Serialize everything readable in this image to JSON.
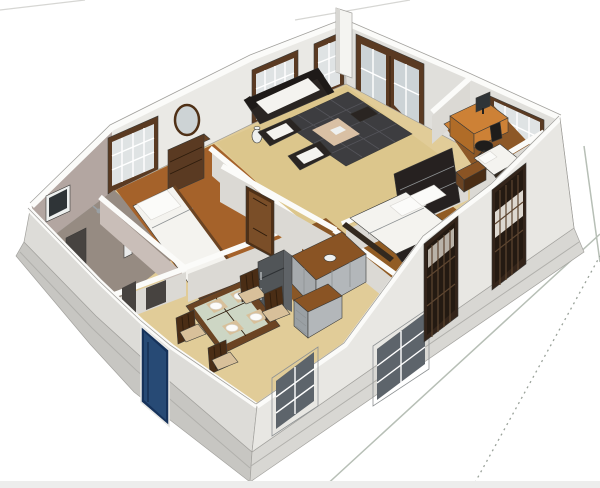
{
  "title": "3D cutaway floor plan model of a single-storey house",
  "scene": {
    "type": "architectural-3d-floor-plan",
    "rooms": [
      "living room",
      "bedroom 1",
      "master bedroom",
      "study bedroom",
      "bathroom suite",
      "dining room",
      "kitchen"
    ],
    "furniture": [
      "sofa",
      "armchair",
      "armchair",
      "checkered rug with mat",
      "floor vase",
      "tv cabinet",
      "dresser with mirror",
      "single bed",
      "double bed with headboard",
      "single bed",
      "dining table with glass top",
      "dining chairs",
      "refrigerator",
      "kitchen counter",
      "kitchen drawer unit",
      "computer desk",
      "monitor",
      "office chair",
      "small dresser",
      "shower",
      "washbasin",
      "wall frame"
    ],
    "openings": [
      "blue front door",
      "french door",
      "interior door",
      "doorway gap",
      "bedroom window",
      "living windows",
      "study window",
      "dining window",
      "kitchen window",
      "grille window master",
      "grille window study",
      "bathroom wall frame"
    ]
  },
  "colors": {
    "bg": "#ffffff",
    "bottom_strip": "#ededec",
    "line_faint": "#d6d6d3",
    "line_ground": "#b7bfb6",
    "line_dotted": "#9aa29a",
    "plinth_se": "#d8d7d3",
    "plinth_sw": "#c7c6c2",
    "plinth_edge": "#b1b0ac",
    "cap": "#fbfbf9",
    "cap_edge": "#a2a19d",
    "edge": "#a3a29e",
    "wall_nw": "#eae9e5",
    "wall_ne": "#e0dfdb",
    "wall_sw": "#dddcd8",
    "wall_se": "#e8e7e3",
    "wall_part": "#dbd9d4",
    "wall_part_dark": "#cfccc6",
    "wall_mauve": "#b3a6a1",
    "wall_mauve2": "#c9beb8",
    "floor_tan": "#e1cc98",
    "floor_living": "#dcc68c",
    "floor_bed1": "#a5622a",
    "floor_master": "#915c24",
    "floor_study": "#8d5827",
    "floor_kitchen": "#8a5726",
    "floor_bath": "#968b82",
    "frame_brown": "#5a3a22",
    "glass_light": "#dfe3e4",
    "glass_blue": "#ccd3d6",
    "glass_dark": "#5d646b",
    "gray_frame": "#c9cdcf",
    "mullion": "#ffffff",
    "lattice_frame": "#33241a",
    "lattice_inner": "#241a12",
    "lattice_bar": "#5d4530",
    "lattice_patch": "#b9b2a8",
    "lattice_bed": "#ddd8d0",
    "door_blue": "#274a75",
    "door_blue_dark": "#16325a",
    "door_brown": "#7a4e28",
    "door_frame": "#4f3016",
    "dark_furn": "#2a2522",
    "darker_furn": "#1e1a18",
    "white_fabric": "#f4f3ef",
    "pillow": "#fbfbf9",
    "rug": "#3d3d40",
    "rug_line": "#54545a",
    "rug_mat": "#d9c0a4",
    "wood": "#6b4423",
    "wood_dark": "#4a2d15",
    "seat_tan": "#d8c09a",
    "table_glass": "#cdd6c4",
    "bed_frame": "#262120",
    "bed_rail": "#33291f",
    "desk": "#cd8136",
    "desk_dark": "#b06c28",
    "chair_black": "#1f1d1b",
    "fridge": "#515558",
    "fridge_top": "#85898d",
    "fridge_side": "#5f6367",
    "counter_top": "#8a5424",
    "cabinet": "#a6aaad",
    "cabinet2": "#b3b7ba",
    "drawer_face": "#9aa0a4",
    "pillar": "#f4f4f1",
    "pillar_shade": "#d8d7d3",
    "screen": "#2f3437",
    "fixture": "#474340",
    "white_item": "#eef0ef",
    "basin": "#e9eaea",
    "mirror": "#cdd3d5"
  }
}
